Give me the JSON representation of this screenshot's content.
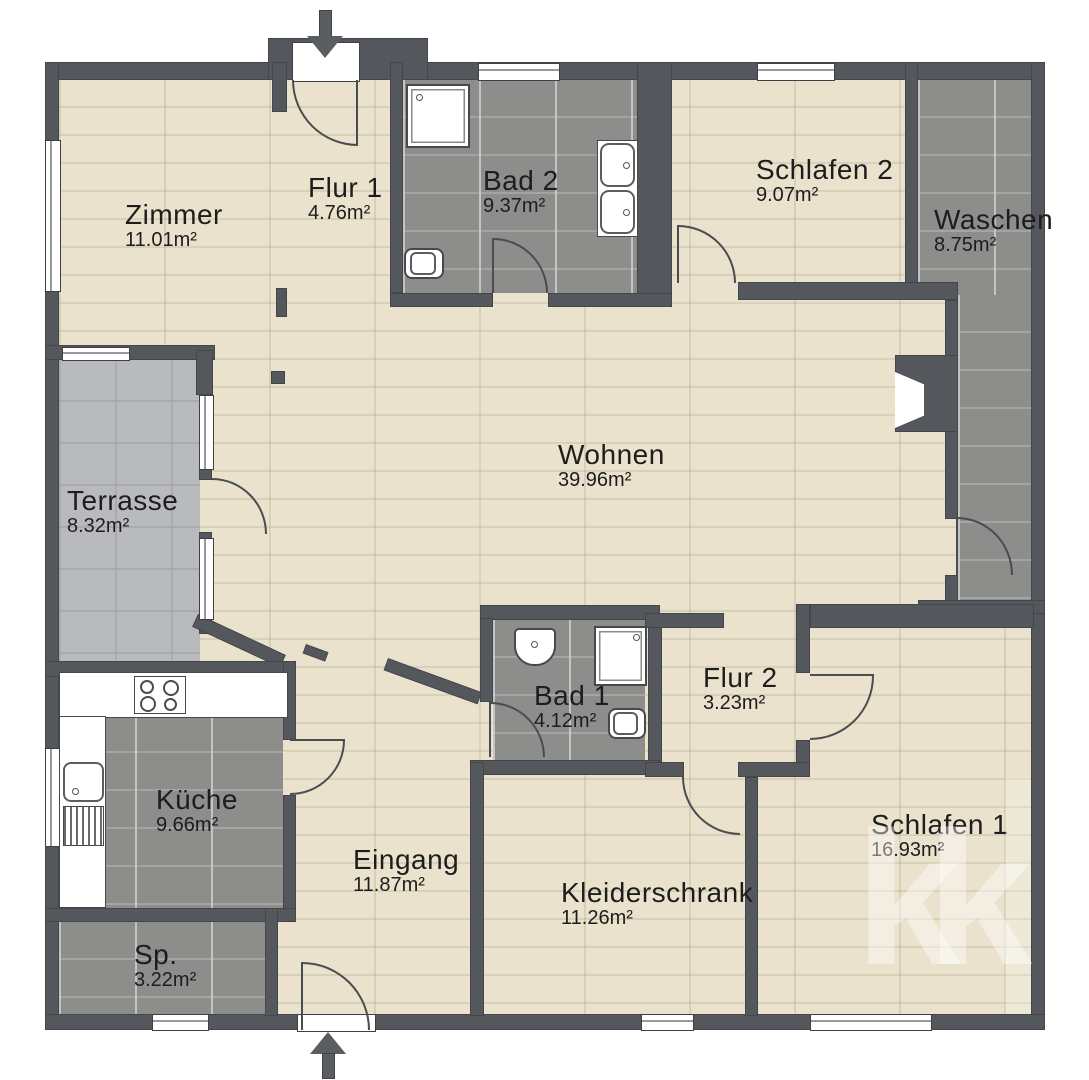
{
  "rooms": [
    {
      "id": "zimmer",
      "name": "Zimmer",
      "area": "11.01m²"
    },
    {
      "id": "flur1",
      "name": "Flur 1",
      "area": "4.76m²"
    },
    {
      "id": "bad2",
      "name": "Bad 2",
      "area": "9.37m²"
    },
    {
      "id": "schlafen2",
      "name": "Schlafen 2",
      "area": "9.07m²"
    },
    {
      "id": "waschen",
      "name": "Waschen",
      "area": "8.75m²"
    },
    {
      "id": "terrasse",
      "name": "Terrasse",
      "area": "8.32m²"
    },
    {
      "id": "wohnen",
      "name": "Wohnen",
      "area": "39.96m²"
    },
    {
      "id": "bad1",
      "name": "Bad 1",
      "area": "4.12m²"
    },
    {
      "id": "flur2",
      "name": "Flur 2",
      "area": "3.23m²"
    },
    {
      "id": "kueche",
      "name": "Küche",
      "area": "9.66m²"
    },
    {
      "id": "eingang",
      "name": "Eingang",
      "area": "11.87m²"
    },
    {
      "id": "kleiderschrank",
      "name": "Kleiderschrank",
      "area": "11.26m²"
    },
    {
      "id": "schlafen1",
      "name": "Schlafen 1",
      "area": "16.93m²"
    },
    {
      "id": "sp",
      "name": "Sp.",
      "area": "3.22m²"
    }
  ],
  "watermark": "kk",
  "colors": {
    "wall": "#54575c",
    "wood-floor": "#e8e0ca",
    "tile-floor": "#8d8d8b",
    "terrace-floor": "#b9babd",
    "fixture": "#ffffff",
    "label-text": "#1d1d1d"
  }
}
